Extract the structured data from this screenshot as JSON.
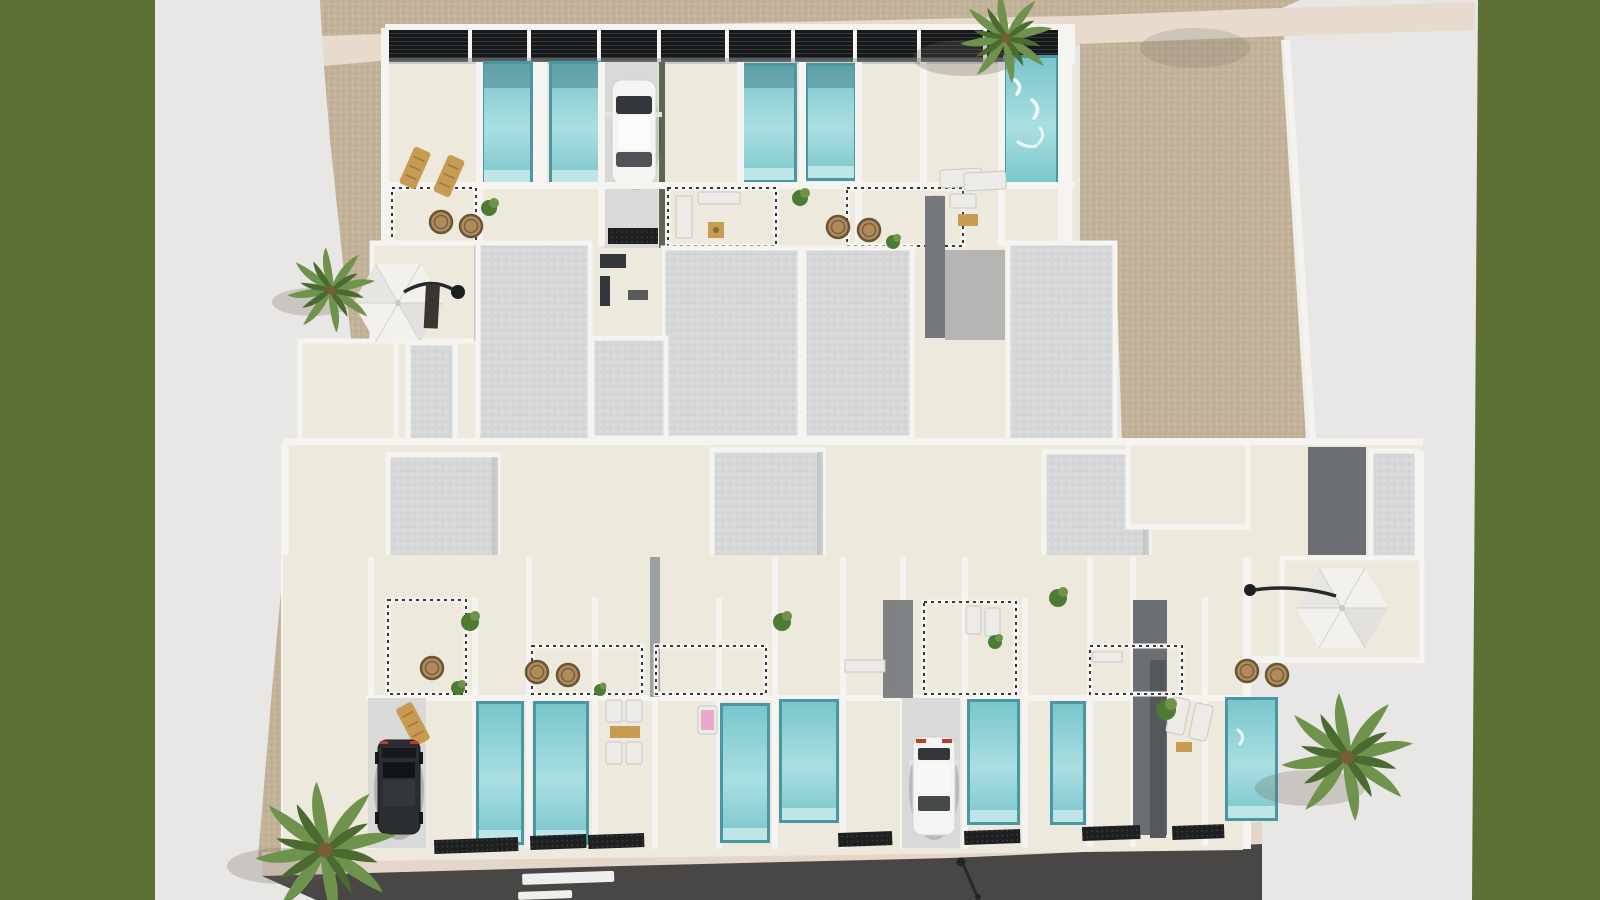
{
  "scene": {
    "type": "architectural-3d-aerial-render",
    "subject": "Top-down 3D rendering of a residential complex: two rows of white townhouses with private plunge pools, sand walkways, lawns and a street",
    "elements": {
      "lawn_strips": 2,
      "palm_trees": 4,
      "parasols": 2,
      "cars_white": 2,
      "cars_dark": 1,
      "pools_top_row": 5,
      "pools_bottom_row": 7,
      "road_lane_dashes": 2,
      "sun_loungers_wood": 3,
      "sun_loungers_white": 10,
      "wicker_chairs": 9,
      "street_lamps": 1
    }
  },
  "colors": {
    "canvas": "#e8e7e5",
    "grass": "#5e7134",
    "grass_dark": "#51642a",
    "sand": "#c2b29a",
    "sand_dark": "#a3937b",
    "sand_light": "#d7cbb6",
    "path_pink": "#e6dbcd",
    "walkway_cream": "#edeadd",
    "wall_white": "#f5f4f1",
    "wall_shade": "#bdc0c2",
    "roof_gray": "#d6d7d8",
    "roof_speckle": "#bcc0c3",
    "pergola_black": "#161819",
    "mat_black": "#1d1f20",
    "pool_rim": "#4a96a3",
    "pool_light": "#aadfe1",
    "pool_mid": "#79c6cc",
    "pool_step": "#c9ebea",
    "road_gray": "#484746",
    "sidewalk_pink": "#e4d6c8",
    "lane_white": "#f1efec",
    "car_white": "#f4f4f2",
    "car_black": "#2b2e30",
    "glass_dark": "#33363a",
    "taillight_red": "#bf3a2e",
    "wood_tan": "#c89b52",
    "wicker_tan": "#b08c5d",
    "wicker_rim": "#6b5335",
    "palm_green": "#6f934c",
    "palm_dark": "#4a6a31",
    "bush_green": "#4e7b33",
    "umbrella_white": "#f2f1ee",
    "umbrella_shade": "#dbdad5",
    "shadow_warm": "#6b6156",
    "steel_dark": "#26292b",
    "dark_wall": "#6b6f73",
    "mid_wall": "#9da0a3"
  }
}
